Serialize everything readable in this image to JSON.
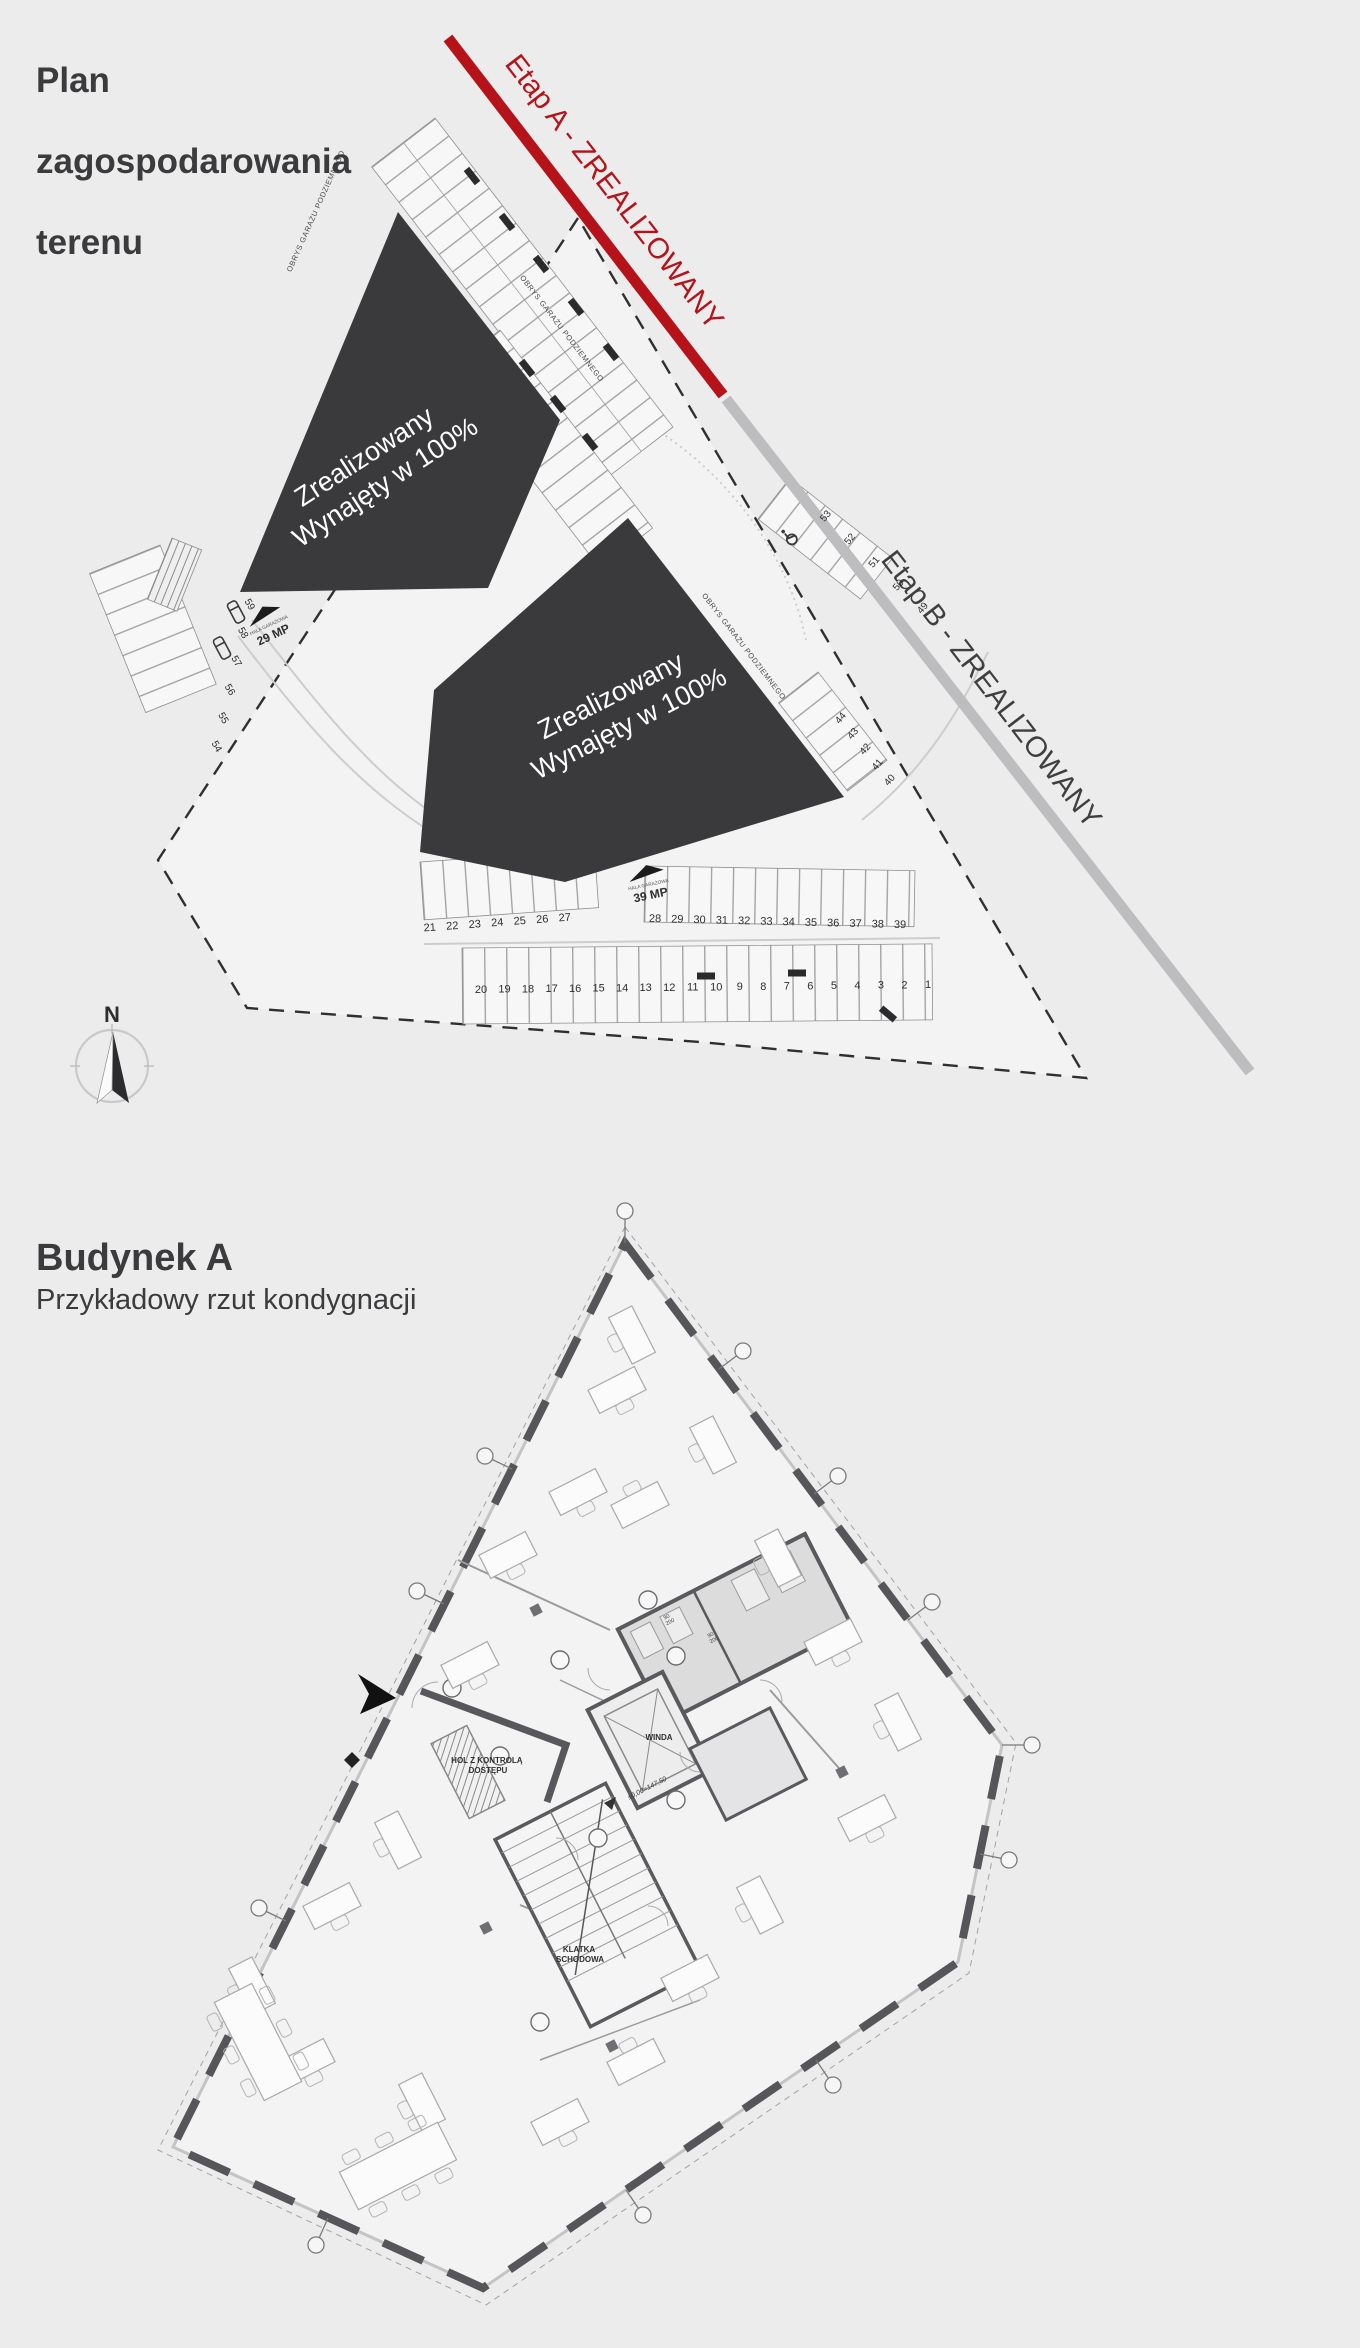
{
  "site_plan": {
    "title_lines": [
      "Plan",
      "zagospodarowania",
      "terenu"
    ],
    "stage_a_label": "Etap A - ZREALIZOWANY",
    "stage_b_label": "Etap B - ZREALIZOWANY",
    "stage_a_color": "#b5121a",
    "stage_b_color": "#bdbdbf",
    "building_a": {
      "line1": "Zrealizowany",
      "line2": "Wynajęty w 100%"
    },
    "building_b": {
      "line1": "Zrealizowany",
      "line2": "Wynajęty w 100%"
    },
    "garage_outline_label": "OBRYS GARAŻU PODZIEMNEGO",
    "hala_garazowa_label": "HALA GARAŻOWA",
    "garage_a_capacity": "39 MP",
    "garage_b_capacity": "29 MP",
    "compass_n": "N",
    "parking_top_left": [
      "21",
      "22",
      "23",
      "24",
      "25",
      "26",
      "27"
    ],
    "parking_top_right": [
      "28",
      "29",
      "30",
      "31",
      "32",
      "33",
      "34",
      "35",
      "36",
      "37",
      "38",
      "39"
    ],
    "parking_bottom": [
      "20",
      "19",
      "18",
      "17",
      "16",
      "15",
      "14",
      "13",
      "12",
      "11",
      "10",
      "9",
      "8",
      "7",
      "6",
      "5",
      "4",
      "3",
      "2",
      "1"
    ],
    "parking_right_upper": [
      "53",
      "52",
      "51",
      "50",
      "49"
    ],
    "parking_right_lower": [
      "44",
      "43",
      "42",
      "41",
      "40"
    ],
    "parking_left": [
      "59",
      "58",
      "57",
      "56",
      "55",
      "54"
    ]
  },
  "floor_plan": {
    "title": "Budynek A",
    "subtitle": "Przykładowy rzut kondygnacji",
    "elevator_label": "WINDA",
    "staircase_label_lines": [
      "KLATKA",
      "SCHODOWA"
    ],
    "hall_label_lines": [
      "HOL Z KONTROLĄ",
      "DOSTĘPU"
    ],
    "level_label": "±0,00=147,50",
    "door_dim_top": "90",
    "door_dim_bottom": "200"
  }
}
